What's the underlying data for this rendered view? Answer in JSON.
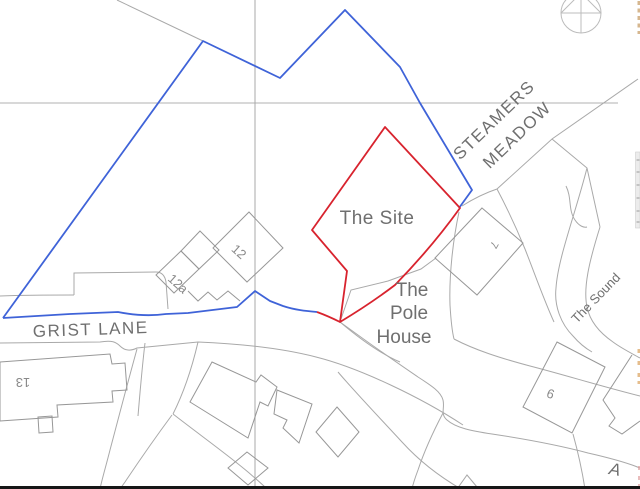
{
  "map": {
    "labels": {
      "site": "The Site",
      "pole_house_line1": "The",
      "pole_house_line2": "Pole",
      "pole_house_line3": "House",
      "grist_lane": "GRIST LANE",
      "steamers_line1": "STEAMERS",
      "steamers_line2": "MEADOW",
      "the_sound": "The Sound",
      "house_12": "12",
      "house_12a": "12a",
      "house_13": "13",
      "house_7": "7",
      "house_6": "6",
      "road_a": "A"
    },
    "colors": {
      "ownership_boundary_blue": "#3f63d8",
      "site_boundary_red": "#d8232e",
      "base_map_lines": "#a9a9a9",
      "label_text": "#6f6f6f"
    },
    "icons": {
      "north_compass": "compass-circle-north-arrow-icon"
    }
  }
}
